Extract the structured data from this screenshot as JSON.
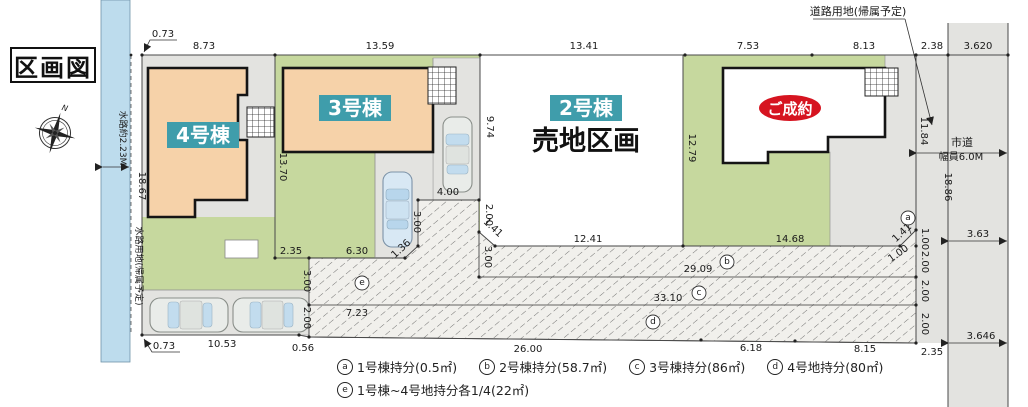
{
  "title": "区画図",
  "colors": {
    "green": "#c6d89e",
    "peach": "#f6d2a9",
    "teal": "#3f9dab",
    "water": "#bddced",
    "gray": "#e3e3e0",
    "red": "#d61420"
  },
  "lots": {
    "lot4": {
      "label": "4号棟"
    },
    "lot3": {
      "label": "3号棟"
    },
    "lot2": {
      "label": "2号棟",
      "status": "売地区画"
    },
    "lot1": {
      "status": "ご成約"
    }
  },
  "annotations": {
    "waterway_width_label": "水路約2.23M",
    "waterway_land": "水路用地(帰属予定)",
    "road_land": "道路用地(帰属予定)",
    "city_road": "市道",
    "road_width": "幅員6.0M",
    "north": "N"
  },
  "dims": {
    "top_offset": "0.73",
    "top_lot4": "8.73",
    "top_lot3": "13.59",
    "top_lot2": "13.41",
    "top_lot1_a": "7.53",
    "top_lot1_b": "8.13",
    "top_road_strip": "2.38",
    "top_road": "3.620",
    "left_edge": "18.67",
    "bottom_offset": "0.73",
    "bottom_parking": "10.53",
    "bottom_jog": "0.56",
    "bottom_mid": "26.00",
    "bottom_d1": "6.18",
    "bottom_d2": "8.15",
    "bottom_road_strip": "2.35",
    "boundary_4_3": "13.70",
    "lot3_bottom_a": "2.35",
    "lot3_bottom_b": "6.30",
    "lot2_left": "9.74",
    "boundary_2_1": "12.79",
    "lot2_bottom": "12.41",
    "lot1_bottom": "14.68",
    "strip_b": "29.09",
    "strip_c": "33.10",
    "strip_e": "7.23",
    "conn_top": "4.00",
    "conn_left": "3.00",
    "conn_left_diag": "1.36",
    "conn_right_a": "2.00",
    "conn_right_diag": "1.41",
    "conn_right_b": "3.00",
    "e_left_a": "3.00",
    "e_left_b": "2.00",
    "right_upper": "11.84",
    "chamfer_v": "1.00",
    "chamfer_diag": "1.41",
    "chamfer_h": "1.00",
    "seg_b": "2.00",
    "seg_c": "2.00",
    "seg_d": "2.00",
    "road_edge": "18.86",
    "road_w_mid": "3.63",
    "road_w_bottom": "3.646"
  },
  "legend": {
    "items": [
      {
        "symbol": "a",
        "label": "1号棟持分(0.5㎡)"
      },
      {
        "symbol": "b",
        "label": "2号棟持分(58.7㎡)"
      },
      {
        "symbol": "c",
        "label": "3号棟持分(86㎡)"
      },
      {
        "symbol": "d",
        "label": "4号地持分(80㎡)"
      },
      {
        "symbol": "e",
        "label": "1号棟~4号地持分各1/4(22㎡)"
      }
    ]
  }
}
